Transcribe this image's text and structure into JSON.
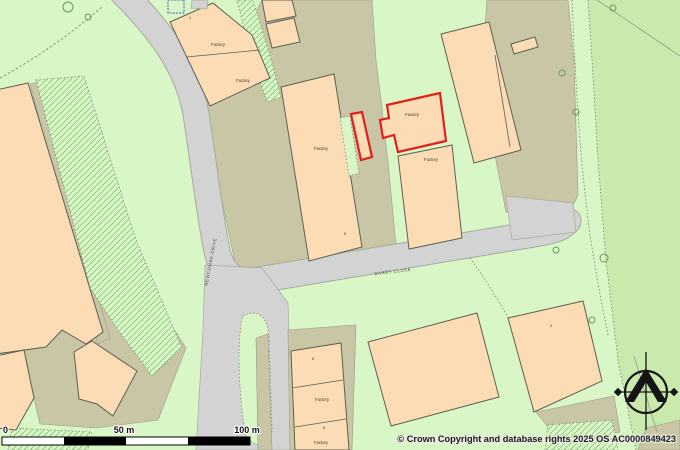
{
  "colors": {
    "background": "#d9f6c6",
    "field_green": "#c9e9ad",
    "building_fill": "#fbdcb4",
    "building_outline": "#5f5f55",
    "yard": "#c9c6a5",
    "yard_edge": "#9a9a8c",
    "road": "#d3d3d3",
    "road_edge": "#a8a8a0",
    "highlight_red": "#e3201b",
    "text": "#3c3c34"
  },
  "map": {
    "labels": [
      {
        "text": "Factory",
        "x": 218,
        "y": 46,
        "rot": 0,
        "kind": "feature"
      },
      {
        "text": "Factory",
        "x": 243,
        "y": 82,
        "rot": 0,
        "kind": "feature"
      },
      {
        "text": "Factory",
        "x": 321,
        "y": 150,
        "rot": 0,
        "kind": "feature"
      },
      {
        "text": "Factory",
        "x": 412,
        "y": 116,
        "rot": 0,
        "kind": "feature"
      },
      {
        "text": "Factory",
        "x": 431,
        "y": 161,
        "rot": 0,
        "kind": "feature"
      },
      {
        "text": "Factory",
        "x": 322,
        "y": 401,
        "rot": 0,
        "kind": "feature"
      },
      {
        "text": "Factory",
        "x": 321,
        "y": 444,
        "rot": 0,
        "kind": "feature"
      },
      {
        "text": "1",
        "x": 190,
        "y": 19,
        "rot": 0,
        "kind": "number"
      },
      {
        "text": "5",
        "x": 345,
        "y": 235,
        "rot": 0,
        "kind": "number"
      },
      {
        "text": "6",
        "x": 313,
        "y": 360,
        "rot": 0,
        "kind": "number"
      },
      {
        "text": "5",
        "x": 324,
        "y": 429,
        "rot": 0,
        "kind": "number"
      },
      {
        "text": "4",
        "x": 551,
        "y": 327,
        "rot": 0,
        "kind": "number"
      },
      {
        "text": "DARBY CLOSE",
        "x": 393,
        "y": 273,
        "rot": -7,
        "kind": "road"
      },
      {
        "text": "NEWCOMBE DRIVE",
        "x": 212,
        "y": 262,
        "rot": -79,
        "kind": "road"
      }
    ]
  },
  "scale_bar": {
    "tick0": "0",
    "tick50": "50 m",
    "tick100": "100 m"
  },
  "attribution": "© Crown Copyright and database rights 2025 OS AC0000849423",
  "icons": {
    "compass": "compass-rose-north-arrow",
    "tree": "tree-icon",
    "highlight": "red-parcel-outline"
  }
}
